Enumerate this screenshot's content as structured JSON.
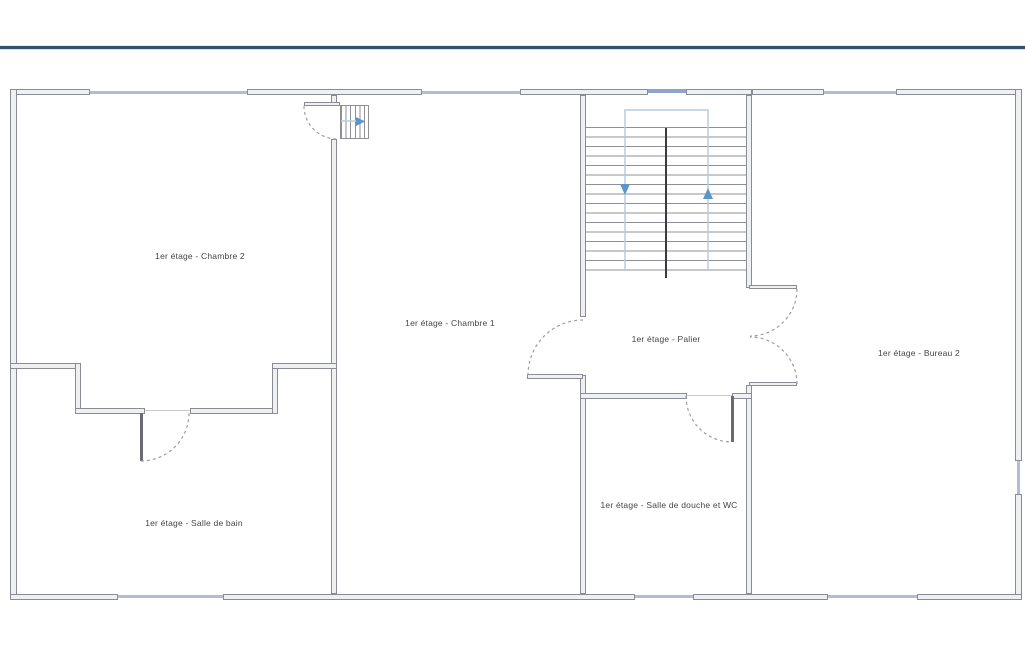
{
  "page": {
    "type": "floor-plan-viewer",
    "floor": "1er étage"
  },
  "floorplan": {
    "rooms": [
      {
        "id": "chambre-2",
        "label": "1er étage - Chambre 2"
      },
      {
        "id": "chambre-1",
        "label": "1er étage - Chambre 1"
      },
      {
        "id": "palier",
        "label": "1er étage - Palier"
      },
      {
        "id": "bureau-2",
        "label": "1er étage - Bureau 2"
      },
      {
        "id": "salle-de-bain",
        "label": "1er étage - Salle de bain"
      },
      {
        "id": "salle-de-douche-wc",
        "label": "1er étage - Salle de douche et WC"
      }
    ],
    "colors": {
      "header_accent": "#33516e",
      "wall_outline": "#8b8b95",
      "window": "#b4bad8",
      "stair_guide": "#b5cde2",
      "stair_arrow": "#5b96c8"
    }
  }
}
